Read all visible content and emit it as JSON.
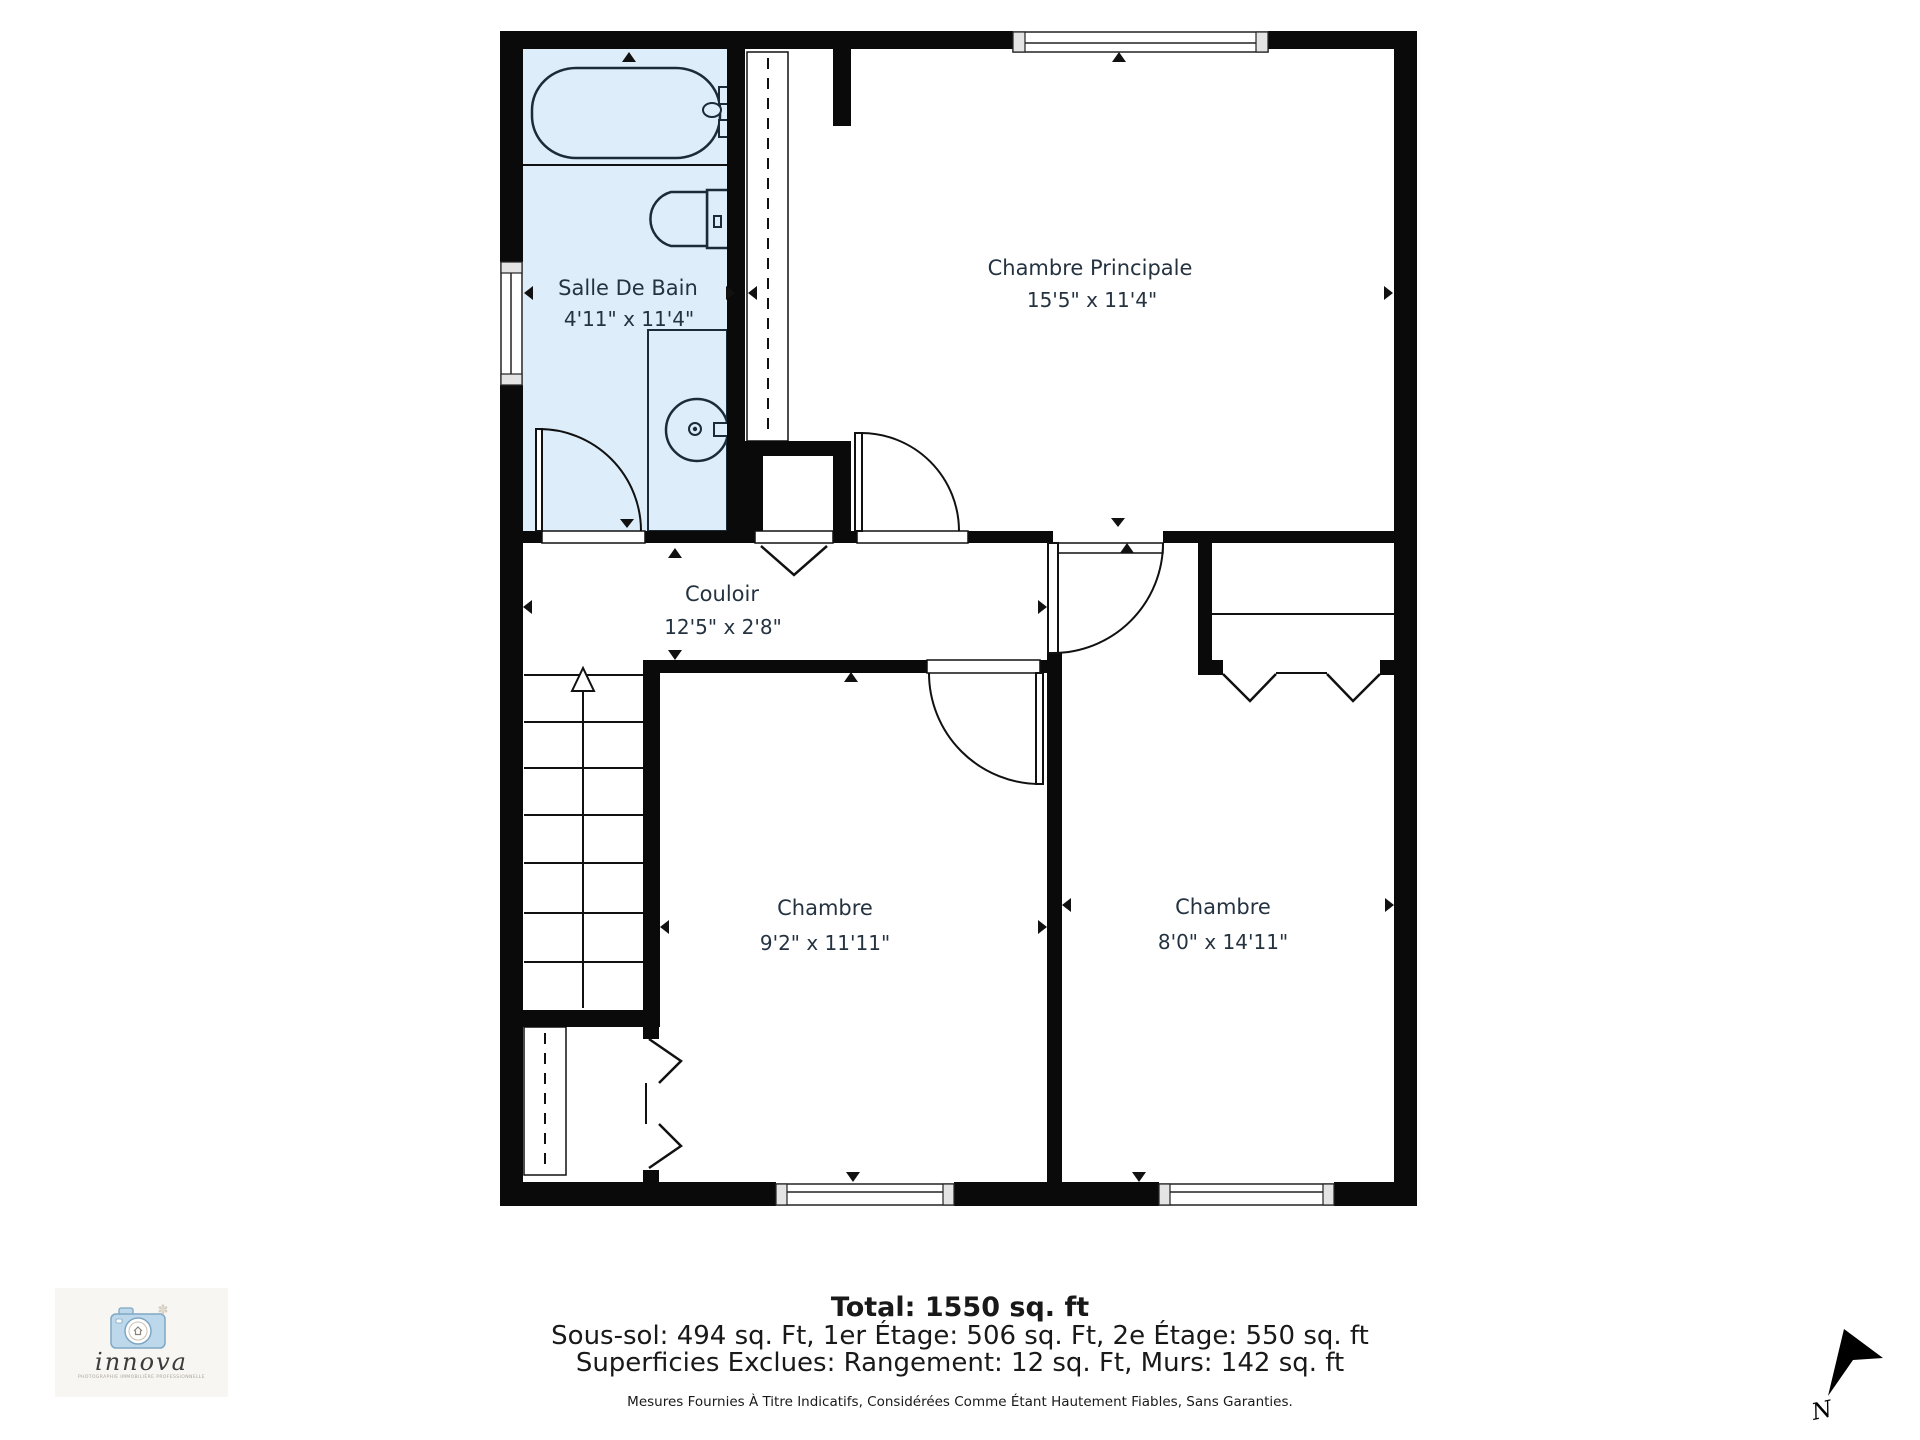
{
  "plan": {
    "rooms": [
      {
        "id": "salle-de-bain",
        "name": "Salle De Bain",
        "dims": "4'11\" x 11'4\""
      },
      {
        "id": "chambre-principale",
        "name": "Chambre Principale",
        "dims": "15'5\" x 11'4\""
      },
      {
        "id": "couloir",
        "name": "Couloir",
        "dims": "12'5\" x 2'8\""
      },
      {
        "id": "chambre-1",
        "name": "Chambre",
        "dims": "9'2\" x 11'11\""
      },
      {
        "id": "chambre-2",
        "name": "Chambre",
        "dims": "8'0\" x 14'11\""
      }
    ],
    "features": [
      "bathtub",
      "toilet",
      "sink-vanity",
      "stairs-up",
      "wardrobe-closet",
      "bifold-closets",
      "windows",
      "doors"
    ]
  },
  "footer": {
    "total": "Total: 1550 sq. ft",
    "levels": "Sous-sol: 494 sq. Ft, 1er Étage: 506 sq. Ft, 2e Étage: 550 sq. ft",
    "exclusions": "Superficies Exclues: Rangement: 12 sq. Ft, Murs: 142 sq. ft",
    "disclaimer": "Mesures Fournies À Titre Indicatifs, Considérées Comme Étant Hautement Fiables, Sans Garanties."
  },
  "logo": {
    "brand": "innova",
    "tagline": "PHOTOGRAPHIE IMMOBILIÈRE PROFESSIONNELLE"
  },
  "compass": {
    "label": "N"
  },
  "colors": {
    "wall": "#0a0a0a",
    "bathroom_fill": "#ddedf9",
    "line": "#111111",
    "label_text": "#253341"
  }
}
